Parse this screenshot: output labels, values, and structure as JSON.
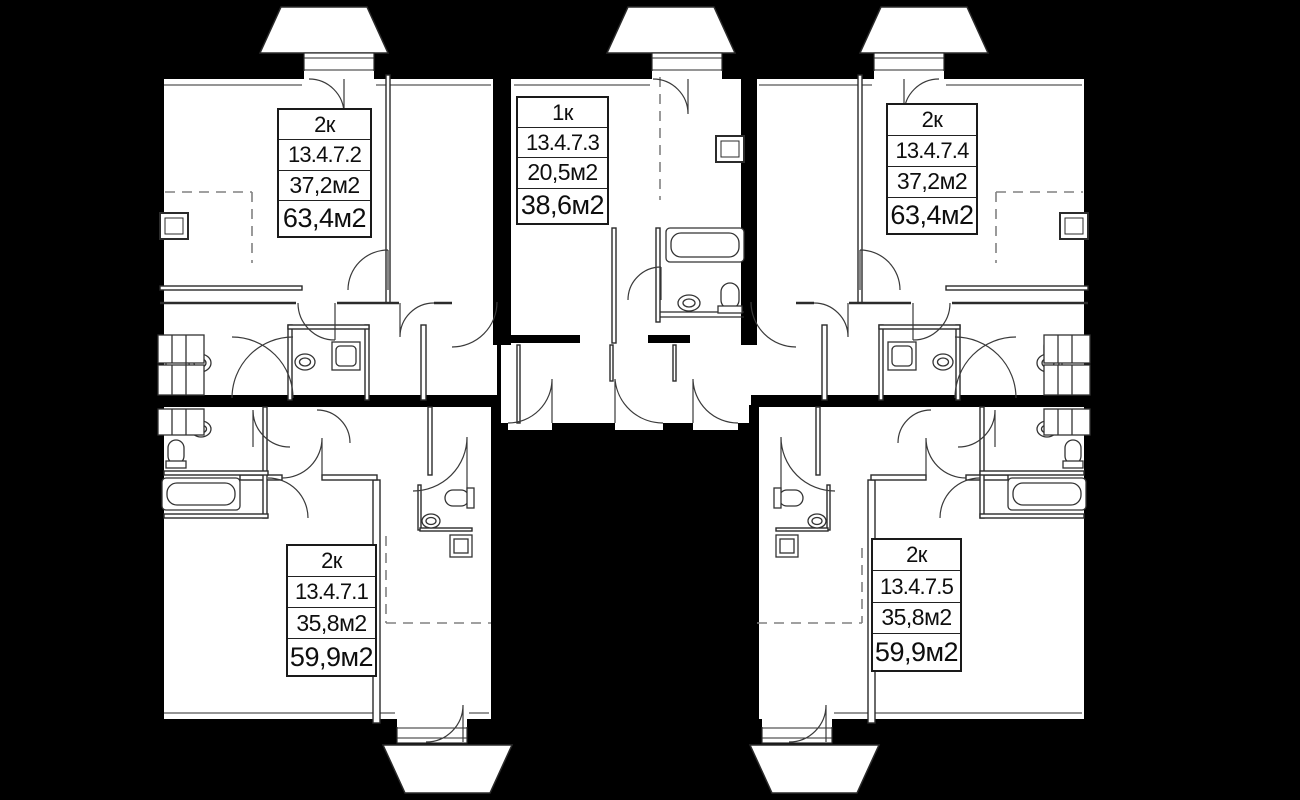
{
  "plan_type": "residential floor plan",
  "units": [
    {
      "type": "2к",
      "number": "13.4.7.2",
      "living_area": "37,2м2",
      "total_area": "63,4м2",
      "position": "top-left"
    },
    {
      "type": "1к",
      "number": "13.4.7.3",
      "living_area": "20,5м2",
      "total_area": "38,6м2",
      "position": "top-center"
    },
    {
      "type": "2к",
      "number": "13.4.7.4",
      "living_area": "37,2м2",
      "total_area": "63,4м2",
      "position": "top-right"
    },
    {
      "type": "2к",
      "number": "13.4.7.1",
      "living_area": "35,8м2",
      "total_area": "59,9м2",
      "position": "bottom-left"
    },
    {
      "type": "2к",
      "number": "13.4.7.5",
      "living_area": "35,8м2",
      "total_area": "59,9м2",
      "position": "bottom-right"
    }
  ],
  "colors": {
    "background": "#000000",
    "floor": "#ffffff",
    "walls": "#000000",
    "thin_lines": "#2b2b2b",
    "dashed_lines": "#808080"
  },
  "balconies": {
    "top_count": 3,
    "bottom_count": 2
  }
}
